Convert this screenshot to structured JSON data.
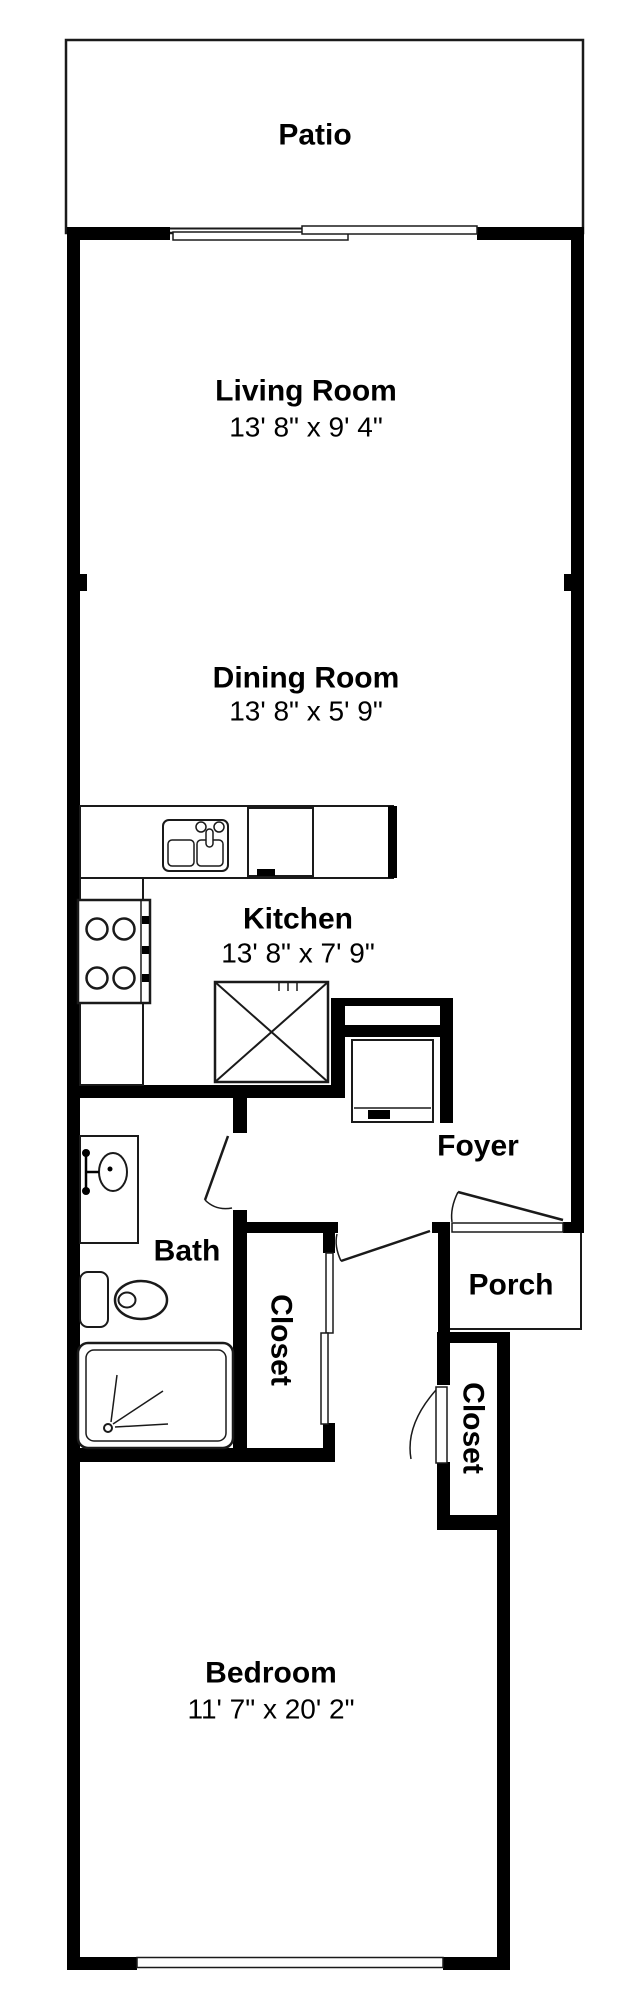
{
  "plan": {
    "title": "One-bedroom apartment floor plan",
    "rooms": {
      "patio": {
        "label": "Patio"
      },
      "living_room": {
        "label": "Living Room",
        "dimensions": "13' 8\" x 9' 4\""
      },
      "dining_room": {
        "label": "Dining Room",
        "dimensions": "13' 8\" x 5' 9\""
      },
      "kitchen": {
        "label": "Kitchen",
        "dimensions": "13' 8\" x 7' 9\""
      },
      "foyer": {
        "label": "Foyer"
      },
      "bath": {
        "label": "Bath"
      },
      "hall_closet": {
        "label": "Closet"
      },
      "porch": {
        "label": "Porch"
      },
      "bedroom_closet": {
        "label": "Closet"
      },
      "bedroom": {
        "label": "Bedroom",
        "dimensions": "11' 7\" x 20' 2\""
      }
    },
    "colors": {
      "wall": "#000000",
      "background": "#ffffff",
      "line": "#1a1a1a"
    }
  }
}
